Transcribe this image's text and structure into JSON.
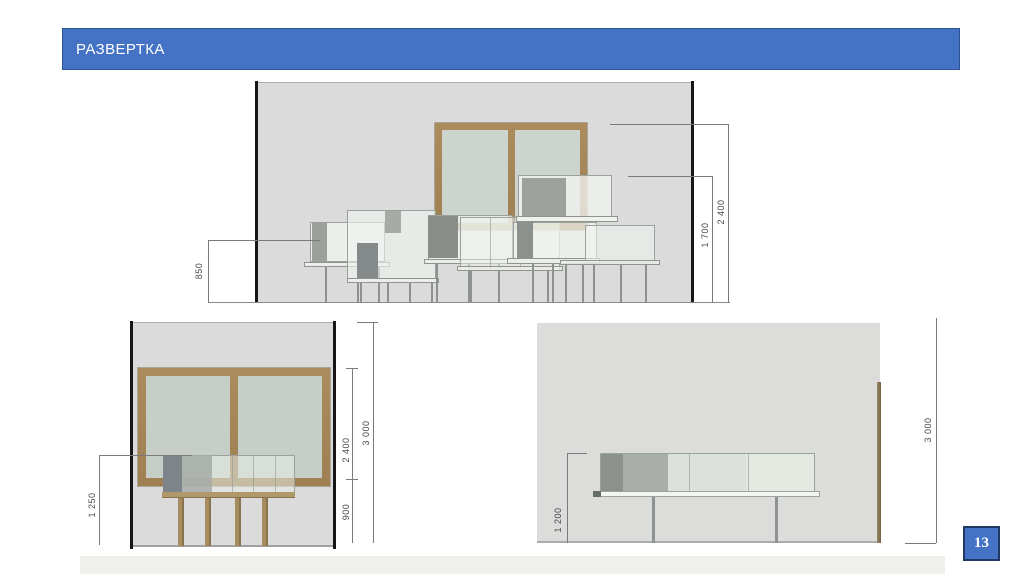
{
  "slide": {
    "title": "РАЗВЕРТКА",
    "page_number": "13"
  },
  "colors": {
    "accent_blue": "#4472C4",
    "accent_blue_border": "#2E5395",
    "page_badge_border": "#203864",
    "wall_gray": "#DBDBDB",
    "window_frame_brown": "#A5875A",
    "window_glass": "#CDD3CD",
    "dark_cabinet_panel": "#8C918E",
    "dimension_text": "#474747"
  },
  "drawings": [
    {
      "id": "top-elevation",
      "description": "wall elevation with double window and overlapping cabinet modules",
      "dims": {
        "left": "850",
        "right_inner": "1 700",
        "right_outer": "2 400"
      }
    },
    {
      "id": "bottom-left-elevation",
      "description": "wall elevation with large double window and table with cabinets",
      "dims": {
        "left": "1 250",
        "right_window": "2 400",
        "right_sill": "900",
        "right_total": "3 000"
      }
    },
    {
      "id": "bottom-right-elevation",
      "description": "wall elevation with long sideboard on legs",
      "dims": {
        "left": "1 200",
        "right_total": "3 000"
      }
    }
  ]
}
